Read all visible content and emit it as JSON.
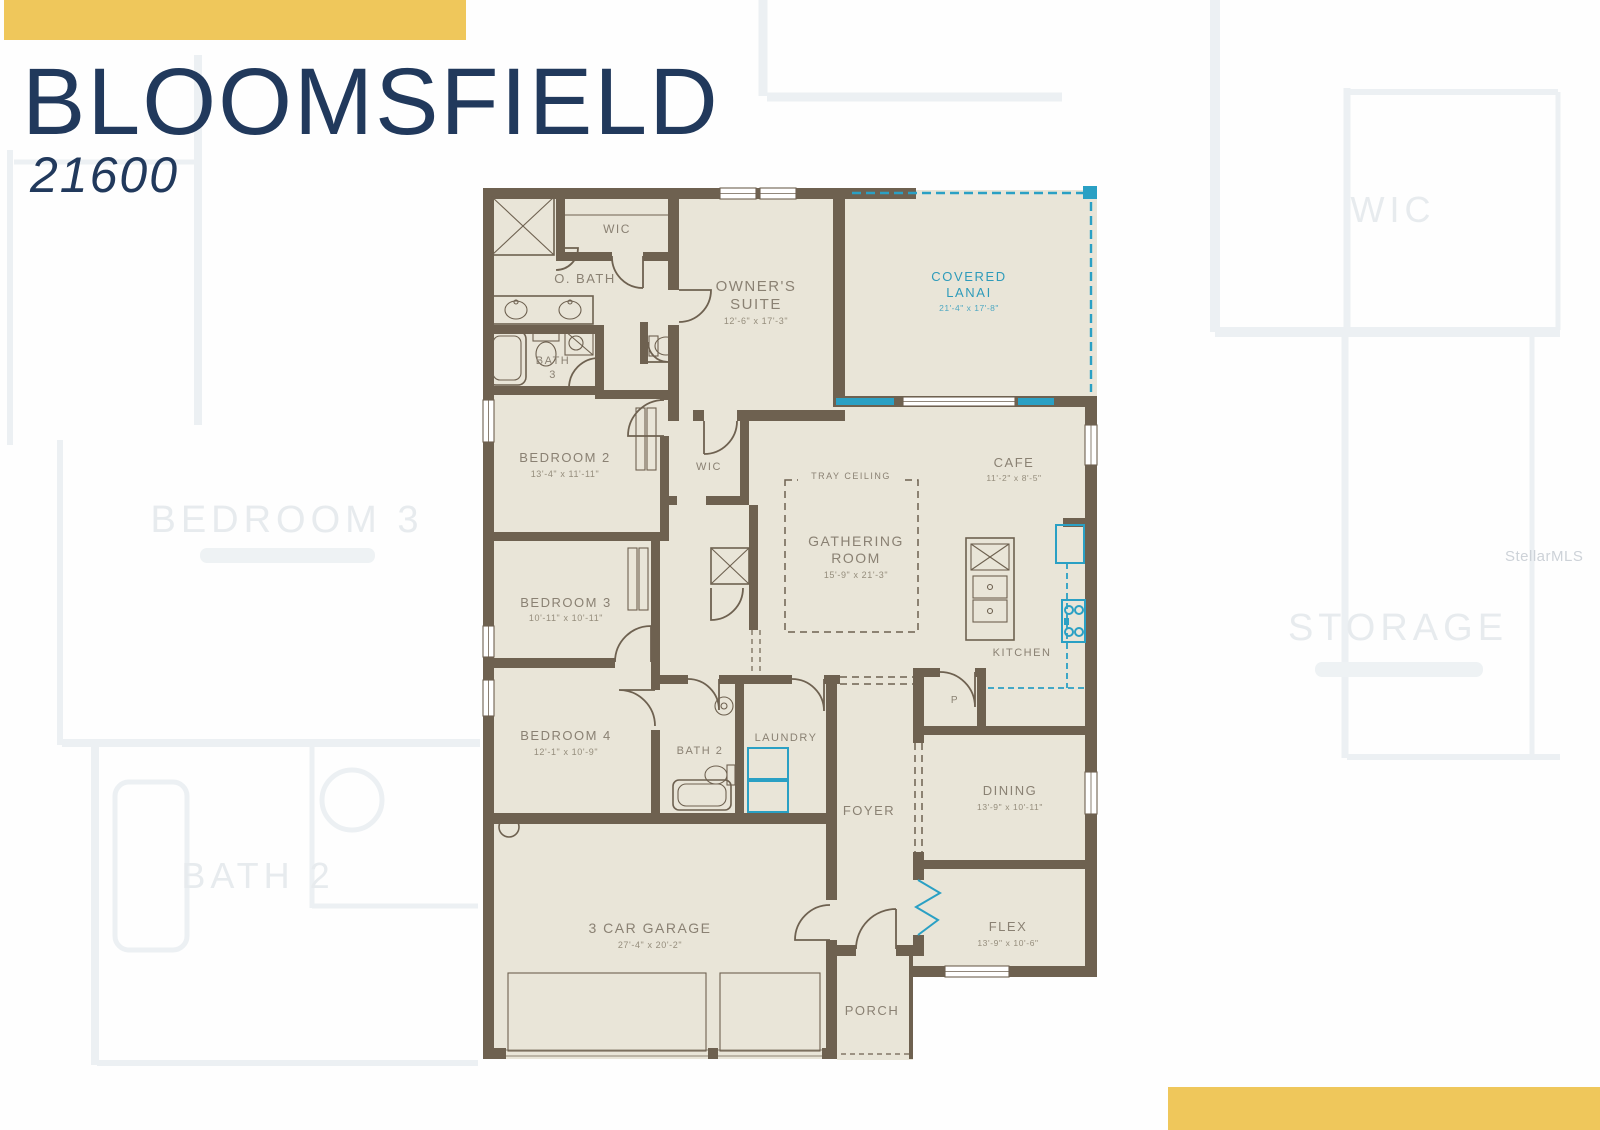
{
  "header": {
    "title": "BLOOMSFIELD",
    "plan_number": "21600"
  },
  "colors": {
    "accent_yellow": "#EFC75B",
    "title_navy": "#21395C",
    "wall_brown": "#6E6150",
    "floor_beige": "#E9E5D8",
    "feature_teal": "#2AA0C4",
    "label_gray": "#8A8173"
  },
  "watermarks": {
    "brand": "StellarMLS",
    "background_labels": [
      {
        "text": "WIC"
      },
      {
        "text": "BEDROOM 3"
      },
      {
        "text": "STORAGE"
      },
      {
        "text": "BATH 2"
      }
    ]
  },
  "rooms": {
    "owner_wic": {
      "name": "WIC"
    },
    "owner_bath": {
      "name": "O. BATH"
    },
    "bath3": {
      "line1": "BATH",
      "line2": "3"
    },
    "owners_suite": {
      "line1": "OWNER'S",
      "line2": "SUITE",
      "dims": "12'-6\" x 17'-3\""
    },
    "covered_lanai": {
      "line1": "COVERED",
      "line2": "LANAI",
      "dims": "21'-4\" x 17'-8\""
    },
    "bedroom2": {
      "name": "BEDROOM 2",
      "dims": "13'-4\" x 11'-11\""
    },
    "hall_wic": {
      "name": "WIC"
    },
    "tray_ceiling": {
      "name": "TRAY CEILING"
    },
    "gathering_room": {
      "line1": "GATHERING",
      "line2": "ROOM",
      "dims": "15'-9\" x 21'-3\""
    },
    "cafe": {
      "name": "CAFE",
      "dims": "11'-2\" x 8'-5\""
    },
    "kitchen": {
      "name": "KITCHEN"
    },
    "bedroom3": {
      "name": "BEDROOM 3",
      "dims": "10'-11\" x 10'-11\""
    },
    "bedroom4": {
      "name": "BEDROOM 4",
      "dims": "12'-1\" x 10'-9\""
    },
    "bath2": {
      "name": "BATH 2"
    },
    "laundry": {
      "name": "LAUNDRY"
    },
    "pantry": {
      "name": "P"
    },
    "foyer": {
      "name": "FOYER"
    },
    "dining": {
      "name": "DINING",
      "dims": "13'-9\" x 10'-11\""
    },
    "flex": {
      "name": "FLEX",
      "dims": "13'-9\" x 10'-6\""
    },
    "garage": {
      "name": "3 CAR GARAGE",
      "dims": "27'-4\" x 20'-2\""
    },
    "porch": {
      "name": "PORCH"
    }
  }
}
